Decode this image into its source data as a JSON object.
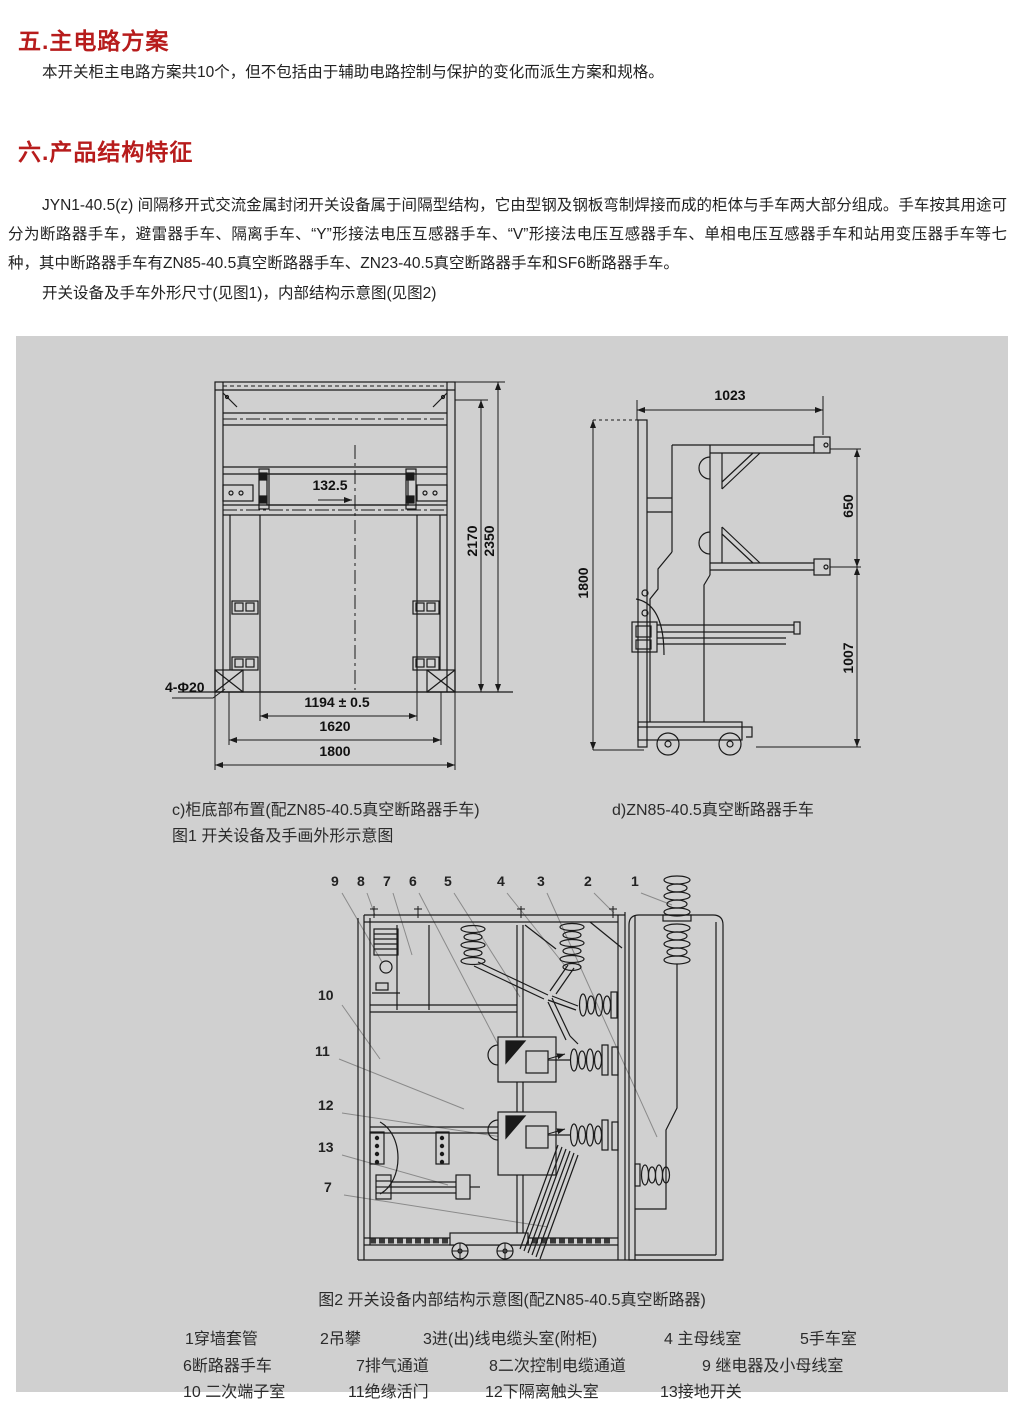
{
  "colors": {
    "heading_accent": "#b71c1c",
    "figure_background": "#d0d0d0",
    "drawing_line": "#1a1a1a",
    "leader_line": "#8a8a8a"
  },
  "sections": {
    "s5": {
      "heading": "五.主电路方案",
      "body": "本开关柜主电路方案共10个，但不包括由于辅助电路控制与保护的变化而派生方案和规格。"
    },
    "s6": {
      "heading": "六.产品结构特征",
      "body": "JYN1-40.5(z) 间隔移开式交流金属封闭开关设备属于间隔型结构，它由型钢及钢板弯制焊接而成的柜体与手车两大部分组成。手车按其用途可分为断路器手车，避雷器手车、隔离手车、“Y”形接法电压互感器手车、“V”形接法电压互感器手车、单相电压互感器手车和站用变压器手车等七种，其中断路器手车有ZN85-40.5真空断路器手车、ZN23-40.5真空断路器手车和SF6断路器手车。",
      "body2": "开关设备及手车外形尺寸(见图1)，内部结构示意图(见图2)"
    }
  },
  "figure1": {
    "front": {
      "dim_132": "132.5",
      "dim_2170": "2170",
      "dim_2350": "2350",
      "dim_holes": "4-Φ20",
      "dim_1194": "1194 ± 0.5",
      "dim_1620": "1620",
      "dim_1800": "1800"
    },
    "side": {
      "dim_1023": "1023",
      "dim_1800": "1800",
      "dim_650": "650",
      "dim_1007": "1007"
    },
    "caption_c": "c)柜底部布置(配ZN85-40.5真空断路器手车)",
    "caption_fig": "图1 开关设备及手画外形示意图",
    "caption_d": "d)ZN85-40.5真空断路器手车"
  },
  "figure2": {
    "caption": "图2 开关设备内部结构示意图(配ZN85-40.5真空断路器)",
    "callouts": {
      "c9": "9",
      "c8": "8",
      "c7": "7",
      "c6": "6",
      "c5": "5",
      "c4": "4",
      "c3": "3",
      "c2": "2",
      "c1": "1",
      "c10": "10",
      "c11": "11",
      "c12": "12",
      "c13": "13",
      "c7b": "7"
    },
    "legend": {
      "row1": [
        "1穿墙套管",
        "2吊攀",
        "3进(出)线电缆头室(附柜)",
        "4 主母线室",
        "5手车室"
      ],
      "row2": [
        "6断路器手车",
        "7排气通道",
        "8二次控制电缆通道",
        "9 继电器及小母线室"
      ],
      "row3": [
        "10 二次端子室",
        "11绝缘活门",
        "12下隔离触头室",
        "13接地开关"
      ]
    }
  }
}
